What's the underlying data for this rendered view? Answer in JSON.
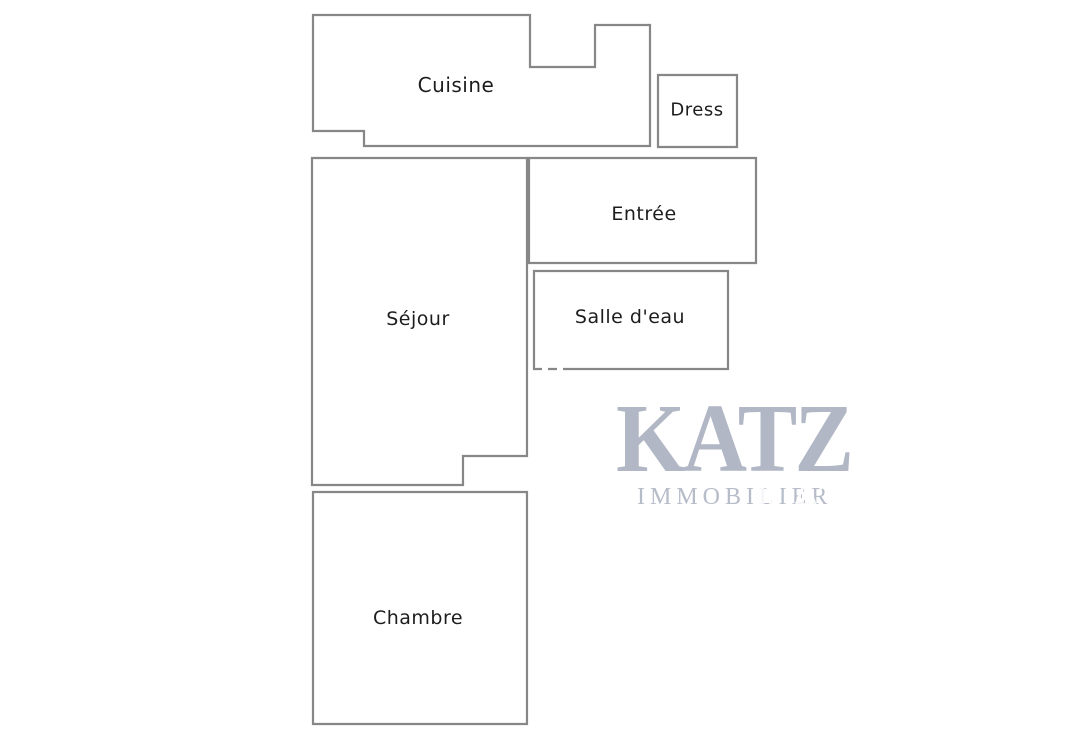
{
  "floorplan": {
    "rooms": [
      {
        "label": "Cuisine"
      },
      {
        "label": "Dress"
      },
      {
        "label": "Entrée"
      },
      {
        "label": "Séjour"
      },
      {
        "label": "Salle d'eau"
      },
      {
        "label": "Chambre"
      }
    ],
    "watermark": {
      "brand": "KATZ",
      "tagline": "IMMOBILIER",
      "ghost": "KATZ"
    },
    "colors": {
      "wall_line": "#878787",
      "label_text": "#1d1d1d",
      "watermark_brand": "#b2b7c5",
      "watermark_tagline": "#b7bcc9",
      "background": "#ffffff"
    }
  }
}
